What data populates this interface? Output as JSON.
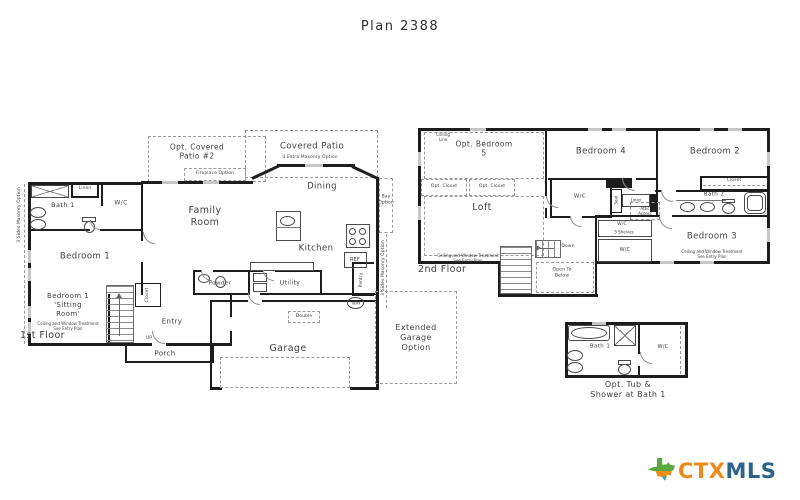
{
  "title": "Plan 2388",
  "notes": {
    "ceiling_window": "Ceiling and Window Treatment\nSee Entry Plan",
    "masonry_sides": "3 Sides Masonry Option"
  },
  "floor1": {
    "label": "1st Floor",
    "bath1": "Bath 1",
    "wc": "W/C",
    "linen": "Linen",
    "bedroom1": "Bedroom 1",
    "sitting_room": "Bedroom 1\n'Sitting\nRoom'",
    "opt_patio": "Opt. Covered\nPatio #2",
    "fireplace_option": "Fireplace Option",
    "covered_patio": "Covered Patio",
    "masonry_option": "4 Extra Masonry Option",
    "family_room": "Family\nRoom",
    "dining": "Dining",
    "bay_option": "Bay\nOption",
    "kitchen": "Kitchen",
    "ref": "REF",
    "pantry": "Pantry",
    "powder": "Powder",
    "utility": "Utility",
    "entry": "Entry",
    "closet": "Closet",
    "up": "UP",
    "porch": "Porch",
    "garage": "Garage",
    "double_door": "Double",
    "water_heater": "W/H",
    "extended_garage": "Extended\nGarage\nOption"
  },
  "floor2": {
    "label": "2nd Floor",
    "opt_bedroom5": "Opt. Bedroom\n5",
    "ceiling_line": "Ceiling\nLine",
    "opt_closet": "Opt. Closet",
    "loft": "Loft",
    "bedroom4": "Bedroom 4",
    "bedroom2": "Bedroom 2",
    "bedroom3": "Bedroom 3",
    "bath2": "Bath 2",
    "closet": "Closet",
    "wc": "W/C",
    "linen": "Linen",
    "seat": "Seat",
    "attic_access": "Attic\nAccess",
    "shelves": "5 Shelves",
    "down": "Down",
    "open_below": "Open To\nBelow"
  },
  "bath_option": {
    "bath1": "Bath 1",
    "wc": "W/C",
    "caption": "Opt. Tub &\nShower at Bath 1"
  },
  "logo": {
    "ctx": "CTX",
    "mls": "MLS"
  }
}
